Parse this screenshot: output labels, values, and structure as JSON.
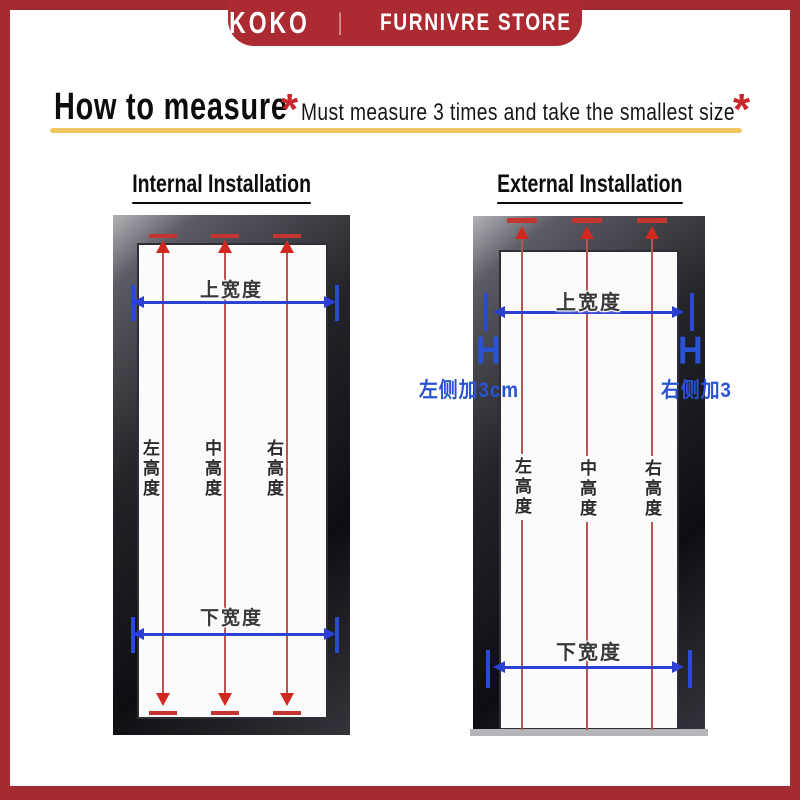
{
  "banner": {
    "brand": "KOKO",
    "divider": "|",
    "store": "FURNIVRE STORE"
  },
  "header": {
    "title": "How to measure",
    "asterisk_left": "*",
    "subtitle": "Must measure 3 times and take the smallest size",
    "asterisk_right": "*"
  },
  "diagrams": {
    "internal": {
      "heading": "Internal Installation",
      "top_width": "上宽度",
      "bottom_width": "下宽度",
      "heights": [
        "左高度",
        "中高度",
        "右高度"
      ]
    },
    "external": {
      "heading": "External Installation",
      "top_width": "上宽度",
      "bottom_width": "下宽度",
      "heights": [
        "左高度",
        "中高度",
        "右高度"
      ],
      "left_note": "左侧加3cm",
      "right_note": "右侧加3",
      "add_mark": "H"
    }
  },
  "colors": {
    "border_red": "#A52B33",
    "banner_red": "#AC2A31",
    "gold_underline": "#EFC75E",
    "asterisk_red": "#C9262C",
    "dimension_blue": "#2B3FD0",
    "note_blue": "#2953D2",
    "measure_line_red": "#B9554F",
    "arrow_red": "#D02A20"
  }
}
